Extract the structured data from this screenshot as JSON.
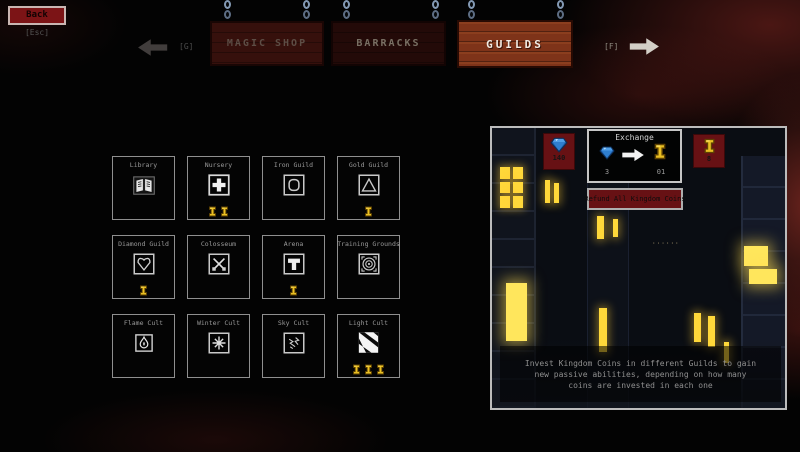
{
  "back": {
    "label": "Back",
    "shortcut": "[Esc]"
  },
  "nav": {
    "prev_shortcut": "[G]",
    "next_shortcut": "[F]",
    "tabs": [
      {
        "label": "MAGIC SHOP",
        "active": false
      },
      {
        "label": "BARRACKS",
        "active": false
      },
      {
        "label": "GUILDS",
        "active": true
      }
    ]
  },
  "guilds": [
    {
      "name": "Library",
      "icon": "book-icon",
      "coins": 0
    },
    {
      "name": "Nursery",
      "icon": "cross-icon",
      "coins": 2
    },
    {
      "name": "Iron Guild",
      "icon": "iron-plate-icon",
      "coins": 0
    },
    {
      "name": "Gold Guild",
      "icon": "triangle-icon",
      "coins": 1
    },
    {
      "name": "Diamond Guild",
      "icon": "diamond-icon",
      "coins": 1
    },
    {
      "name": "Colosseum",
      "icon": "crossed-swords-icon",
      "coins": 0
    },
    {
      "name": "Arena",
      "icon": "hammer-icon",
      "coins": 1
    },
    {
      "name": "Training Grounds",
      "icon": "target-icon",
      "coins": 0
    },
    {
      "name": "Flame Cult",
      "icon": "flame-icon",
      "coins": 0
    },
    {
      "name": "Winter Cult",
      "icon": "snowflake-icon",
      "coins": 0
    },
    {
      "name": "Sky Cult",
      "icon": "lightning-icon",
      "coins": 0
    },
    {
      "name": "Light Cult",
      "icon": "light-stripes-icon",
      "coins": 3
    }
  ],
  "panel": {
    "gem_balance": "140",
    "coin_balance": "8",
    "exchange": {
      "title": "Exchange",
      "gem_cost": "3",
      "coin_gain": "01"
    },
    "refund_label": "Refund All Kingdom Coins",
    "description_lines": [
      "Invest Kingdom Coins in different Guilds to gain",
      "new passive abilities, depending on how many",
      "coins are invested in each one"
    ]
  },
  "colors": {
    "accent_red": "#671114",
    "coin_gold": "#e9bf23",
    "gem_blue": "#2f7fd0",
    "window_glow": "#ffd83a",
    "sign_wood": "#7e3319"
  }
}
